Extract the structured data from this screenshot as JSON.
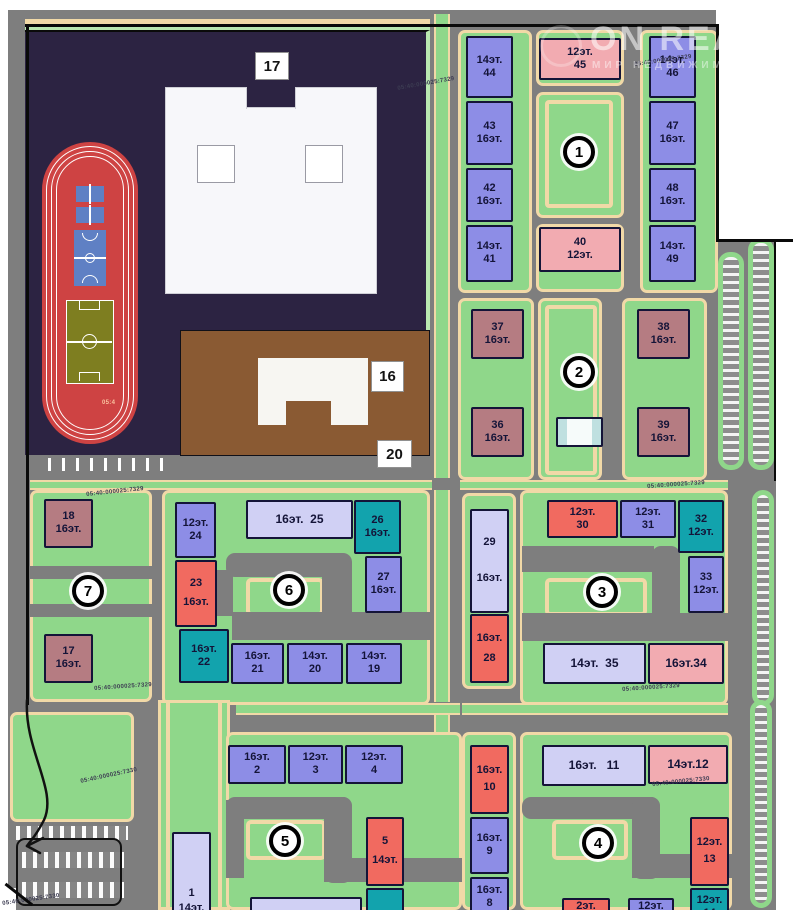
{
  "palette": {
    "road": "#7e7e7e",
    "green": "#8fd78a",
    "green_light": "#b9e8b0",
    "path": "#f1d9a7",
    "purple": "#8d8de6",
    "lavender": "#d0d0f4",
    "red": "#f16a60",
    "pink": "#f2abb1",
    "teal": "#12a3ad",
    "maroon": "#b57c82",
    "school": "#2c2342",
    "kinder": "#8a5a33",
    "stadium": "#ce4343",
    "field": "#7e7e20",
    "court": "#5f80c4",
    "white_bldg": "#f4faf9",
    "boundary": "#0a0a0a"
  },
  "watermark": {
    "brand": "ON REALT",
    "tagline": "МИР НЕДВИЖИМОСТИ"
  },
  "site_labels": [
    {
      "text": "17",
      "x": 255,
      "y": 52,
      "w": 34,
      "h": 28
    },
    {
      "text": "16",
      "x": 371,
      "y": 361,
      "w": 33,
      "h": 31
    },
    {
      "text": "20",
      "x": 377,
      "y": 440,
      "w": 35,
      "h": 28
    }
  ],
  "quarter_badges": [
    {
      "n": "1",
      "x": 563,
      "y": 136
    },
    {
      "n": "2",
      "x": 563,
      "y": 356
    },
    {
      "n": "3",
      "x": 586,
      "y": 576
    },
    {
      "n": "4",
      "x": 582,
      "y": 827
    },
    {
      "n": "5",
      "x": 269,
      "y": 825
    },
    {
      "n": "6",
      "x": 273,
      "y": 574
    },
    {
      "n": "7",
      "x": 72,
      "y": 575
    }
  ],
  "buildings": [
    {
      "id": "44",
      "x": 466,
      "y": 36,
      "w": 47,
      "h": 62,
      "c": "purple",
      "lines": [
        "14эт.",
        "44"
      ]
    },
    {
      "id": "43",
      "x": 466,
      "y": 101,
      "w": 47,
      "h": 64,
      "c": "purple",
      "lines": [
        "43",
        "16эт."
      ]
    },
    {
      "id": "42",
      "x": 466,
      "y": 168,
      "w": 47,
      "h": 54,
      "c": "purple",
      "lines": [
        "42",
        "16эт."
      ]
    },
    {
      "id": "41",
      "x": 466,
      "y": 225,
      "w": 47,
      "h": 57,
      "c": "purple",
      "lines": [
        "14эт.",
        "41"
      ]
    },
    {
      "id": "45",
      "x": 539,
      "y": 38,
      "w": 82,
      "h": 42,
      "c": "pink",
      "lines": [
        "12эт.",
        "45"
      ]
    },
    {
      "id": "40",
      "x": 539,
      "y": 227,
      "w": 82,
      "h": 45,
      "c": "pink",
      "lines": [
        "40",
        "12эт."
      ]
    },
    {
      "id": "46",
      "x": 649,
      "y": 36,
      "w": 47,
      "h": 62,
      "c": "purple",
      "lines": [
        "14эт.",
        "46"
      ]
    },
    {
      "id": "47",
      "x": 649,
      "y": 101,
      "w": 47,
      "h": 64,
      "c": "purple",
      "lines": [
        "47",
        "16эт."
      ]
    },
    {
      "id": "48",
      "x": 649,
      "y": 168,
      "w": 47,
      "h": 54,
      "c": "purple",
      "lines": [
        "48",
        "16эт."
      ]
    },
    {
      "id": "49",
      "x": 649,
      "y": 225,
      "w": 47,
      "h": 57,
      "c": "purple",
      "lines": [
        "14эт.",
        "49"
      ]
    },
    {
      "id": "37",
      "x": 471,
      "y": 309,
      "w": 53,
      "h": 50,
      "c": "maroon",
      "lines": [
        "37",
        "16эт."
      ]
    },
    {
      "id": "38",
      "x": 637,
      "y": 309,
      "w": 53,
      "h": 50,
      "c": "maroon",
      "lines": [
        "38",
        "16эт."
      ]
    },
    {
      "id": "36",
      "x": 471,
      "y": 407,
      "w": 53,
      "h": 50,
      "c": "maroon",
      "lines": [
        "36",
        "16эт."
      ]
    },
    {
      "id": "39",
      "x": 637,
      "y": 407,
      "w": 53,
      "h": 50,
      "c": "maroon",
      "lines": [
        "39",
        "16эт."
      ]
    },
    {
      "id": "community",
      "x": 556,
      "y": 417,
      "w": 47,
      "h": 30,
      "c": "white_bldg",
      "lines": []
    },
    {
      "id": "18",
      "x": 44,
      "y": 499,
      "w": 49,
      "h": 49,
      "c": "maroon",
      "lines": [
        "18",
        "16эт."
      ]
    },
    {
      "id": "17",
      "x": 44,
      "y": 634,
      "w": 49,
      "h": 49,
      "c": "maroon",
      "lines": [
        "17",
        "16эт."
      ]
    },
    {
      "id": "24",
      "x": 175,
      "y": 502,
      "w": 41,
      "h": 56,
      "c": "purple",
      "lines": [
        "12эт.",
        "24"
      ]
    },
    {
      "id": "23",
      "x": 175,
      "y": 560,
      "w": 42,
      "h": 67,
      "c": "red",
      "lines": [
        "23",
        "16эт."
      ],
      "gap": 7
    },
    {
      "id": "22",
      "x": 179,
      "y": 629,
      "w": 50,
      "h": 54,
      "c": "teal",
      "lines": [
        "16эт.",
        "22"
      ]
    },
    {
      "id": "25",
      "x": 246,
      "y": 500,
      "w": 107,
      "h": 39,
      "c": "lavender",
      "lines": [
        "16эт.  25"
      ],
      "fs": 12
    },
    {
      "id": "26",
      "x": 354,
      "y": 500,
      "w": 47,
      "h": 54,
      "c": "teal",
      "lines": [
        "26",
        "16эт."
      ]
    },
    {
      "id": "27",
      "x": 365,
      "y": 556,
      "w": 37,
      "h": 57,
      "c": "purple",
      "lines": [
        "27",
        "16эт."
      ]
    },
    {
      "id": "21",
      "x": 231,
      "y": 643,
      "w": 53,
      "h": 41,
      "c": "purple",
      "lines": [
        "16эт.",
        "21"
      ]
    },
    {
      "id": "20",
      "x": 287,
      "y": 643,
      "w": 56,
      "h": 41,
      "c": "purple",
      "lines": [
        "14эт.",
        "20"
      ]
    },
    {
      "id": "19",
      "x": 346,
      "y": 643,
      "w": 56,
      "h": 41,
      "c": "purple",
      "lines": [
        "14эт.",
        "19"
      ]
    },
    {
      "id": "29",
      "x": 470,
      "y": 509,
      "w": 39,
      "h": 104,
      "c": "lavender",
      "lines": [
        "29",
        "16эт."
      ],
      "gap": 24
    },
    {
      "id": "28",
      "x": 470,
      "y": 614,
      "w": 39,
      "h": 69,
      "c": "red",
      "lines": [
        "16эт.",
        "28"
      ],
      "gap": 8
    },
    {
      "id": "30",
      "x": 547,
      "y": 500,
      "w": 71,
      "h": 38,
      "c": "red",
      "lines": [
        "12эт.",
        "30"
      ]
    },
    {
      "id": "31",
      "x": 620,
      "y": 500,
      "w": 56,
      "h": 38,
      "c": "purple",
      "lines": [
        "12эт.",
        "31"
      ]
    },
    {
      "id": "32",
      "x": 678,
      "y": 500,
      "w": 46,
      "h": 53,
      "c": "teal",
      "lines": [
        "32",
        "12эт."
      ]
    },
    {
      "id": "33",
      "x": 688,
      "y": 556,
      "w": 36,
      "h": 57,
      "c": "purple",
      "lines": [
        "33",
        "12эт."
      ]
    },
    {
      "id": "35",
      "x": 543,
      "y": 643,
      "w": 103,
      "h": 41,
      "c": "lavender",
      "lines": [
        "14эт.  35"
      ],
      "fs": 12
    },
    {
      "id": "34",
      "x": 648,
      "y": 643,
      "w": 76,
      "h": 41,
      "c": "pink",
      "lines": [
        "16эт.34"
      ],
      "fs": 12
    },
    {
      "id": "1",
      "x": 172,
      "y": 832,
      "w": 39,
      "h": 85,
      "c": "lavender",
      "lines": [
        "1",
        "14эт."
      ],
      "gap": 4,
      "align": "end"
    },
    {
      "id": "2",
      "x": 228,
      "y": 745,
      "w": 58,
      "h": 39,
      "c": "purple",
      "lines": [
        "16эт.",
        "2"
      ]
    },
    {
      "id": "3",
      "x": 288,
      "y": 745,
      "w": 55,
      "h": 39,
      "c": "purple",
      "lines": [
        "12эт.",
        "3"
      ]
    },
    {
      "id": "4",
      "x": 345,
      "y": 745,
      "w": 58,
      "h": 39,
      "c": "purple",
      "lines": [
        "12эт.",
        "4"
      ]
    },
    {
      "id": "5",
      "x": 366,
      "y": 817,
      "w": 38,
      "h": 69,
      "c": "red",
      "lines": [
        "5",
        "14эт."
      ],
      "gap": 7
    },
    {
      "id": "6",
      "x": 366,
      "y": 888,
      "w": 38,
      "h": 32,
      "c": "teal",
      "lines": []
    },
    {
      "id": "south-a",
      "x": 250,
      "y": 897,
      "w": 112,
      "h": 20,
      "c": "lavender",
      "lines": []
    },
    {
      "id": "10",
      "x": 470,
      "y": 745,
      "w": 39,
      "h": 69,
      "c": "red",
      "lines": [
        "16эт.",
        "10"
      ],
      "gap": 5
    },
    {
      "id": "9",
      "x": 470,
      "y": 817,
      "w": 39,
      "h": 57,
      "c": "purple",
      "lines": [
        "16эт.",
        "9"
      ]
    },
    {
      "id": "8",
      "x": 470,
      "y": 877,
      "w": 39,
      "h": 41,
      "c": "purple",
      "lines": [
        "16эт.",
        "8"
      ]
    },
    {
      "id": "11",
      "x": 542,
      "y": 745,
      "w": 104,
      "h": 41,
      "c": "lavender",
      "lines": [
        "16эт.   11"
      ],
      "fs": 12
    },
    {
      "id": "12",
      "x": 648,
      "y": 745,
      "w": 80,
      "h": 39,
      "c": "pink",
      "lines": [
        "14эт.12"
      ],
      "fs": 12
    },
    {
      "id": "13",
      "x": 690,
      "y": 817,
      "w": 39,
      "h": 69,
      "c": "red",
      "lines": [
        "12эт.",
        "13"
      ],
      "gap": 5
    },
    {
      "id": "14",
      "x": 690,
      "y": 888,
      "w": 39,
      "h": 38,
      "c": "teal",
      "lines": [
        "12эт.",
        "14"
      ]
    },
    {
      "id": "15",
      "x": 562,
      "y": 898,
      "w": 48,
      "h": 18,
      "c": "red",
      "lines": [
        "2эт."
      ]
    },
    {
      "id": "16",
      "x": 628,
      "y": 898,
      "w": 46,
      "h": 18,
      "c": "purple",
      "lines": [
        "12эт."
      ]
    }
  ],
  "cadastral_labels": [
    {
      "text": "05:40:000025:7329",
      "x": 397,
      "y": 86,
      "r": -10
    },
    {
      "text": "05:40:000025:7329",
      "x": 634,
      "y": 62,
      "r": -8
    },
    {
      "text": "05:40:000025:7329",
      "x": 86,
      "y": 492,
      "r": -6
    },
    {
      "text": "05:40:000025:7329",
      "x": 94,
      "y": 686,
      "r": -4
    },
    {
      "text": "05:40:000025:7329",
      "x": 647,
      "y": 484,
      "r": -4
    },
    {
      "text": "05:40:000025:7329",
      "x": 622,
      "y": 687,
      "r": -4
    },
    {
      "text": "05:40:000025:7330",
      "x": 80,
      "y": 779,
      "r": -12
    },
    {
      "text": "05:40:000025:7330",
      "x": 652,
      "y": 782,
      "r": -6
    },
    {
      "text": "05:40:000025:7330",
      "x": 2,
      "y": 901,
      "r": -8
    },
    {
      "text": "05:4",
      "x": 102,
      "y": 400,
      "r": 0,
      "light": true
    }
  ]
}
